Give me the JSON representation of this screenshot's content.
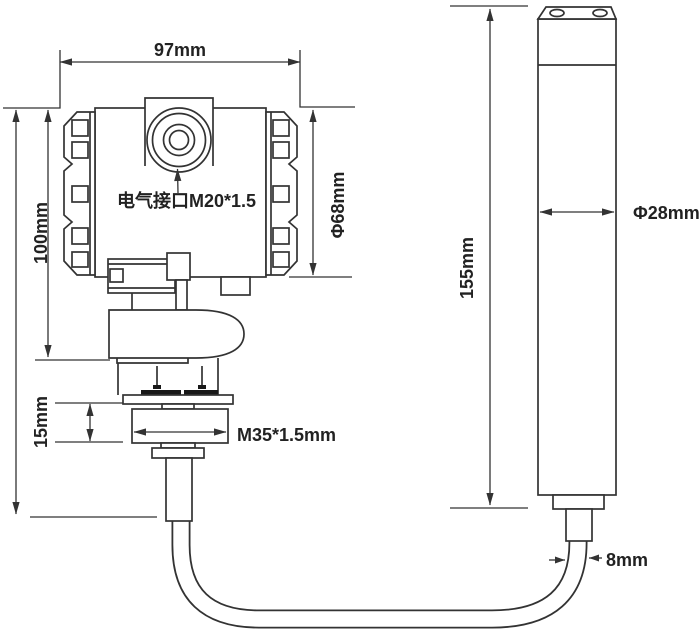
{
  "drawing": {
    "type": "technical-dimension-diagram",
    "subject": "submersible level transmitter with probe and cable",
    "colors": {
      "background": "#ffffff",
      "line": "#333333",
      "text": "#222222",
      "seal_fill": "#181818"
    },
    "transmitter": {
      "width_label": "97mm",
      "height_label": "100mm",
      "electrical_port_label": "电气接口M20*1.5",
      "housing_diameter_label": "Φ68mm",
      "thread_height_label": "15mm",
      "thread_spec_label": "M35*1.5mm"
    },
    "probe": {
      "length_label": "155mm",
      "diameter_label": "Φ28mm",
      "cable_diameter_label": "8mm"
    }
  }
}
